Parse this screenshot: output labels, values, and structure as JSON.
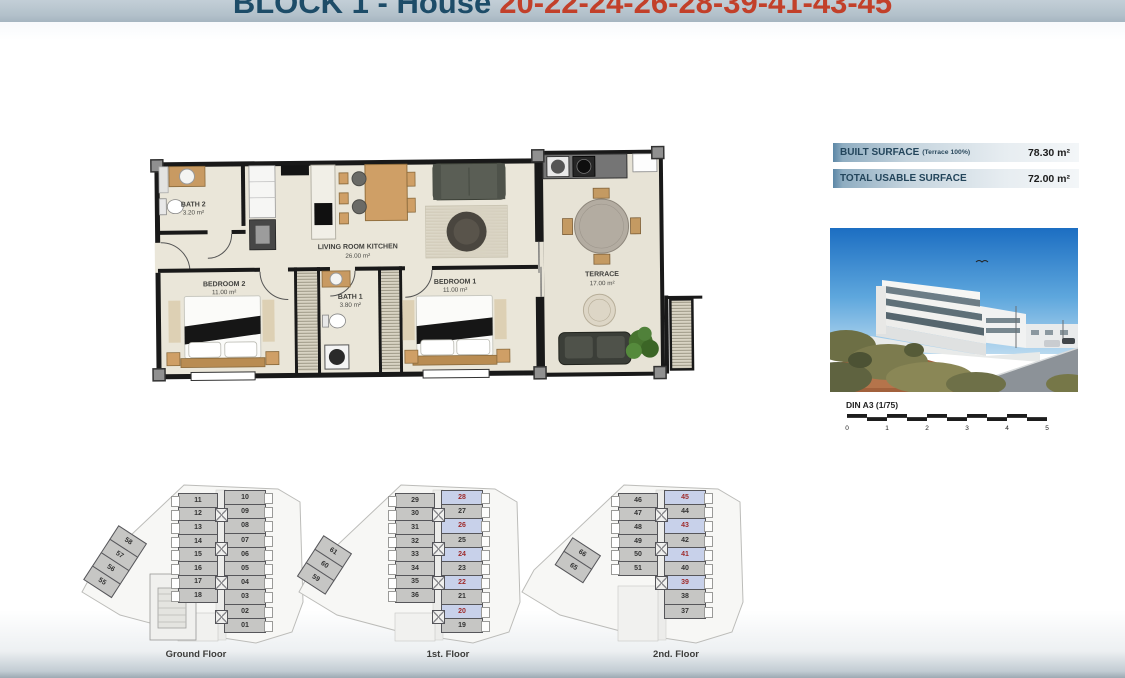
{
  "header": {
    "block_label": "BLOCK 1 - House",
    "house_numbers": "20-22-24-26-28-39-41-43-45"
  },
  "colors": {
    "title_text": "#1d4c68",
    "title_numbers": "#c2402a",
    "header_bar": "#b3c1cb",
    "unit_bg": "#c6c6c4",
    "unit_num": "#333333",
    "highlight_bg": "#c8d1ea",
    "highlight_num": "#9e2b2b"
  },
  "floor_plan": {
    "rooms": [
      {
        "id": "bath2",
        "name": "BATH 2",
        "area": "3.20 m²"
      },
      {
        "id": "living",
        "name": "LIVING ROOM KITCHEN",
        "area": "26.00 m²"
      },
      {
        "id": "bedroom2",
        "name": "BEDROOM 2",
        "area": "11.00 m²"
      },
      {
        "id": "bath1",
        "name": "BATH 1",
        "area": "3.80 m²"
      },
      {
        "id": "bedroom1",
        "name": "BEDROOM 1",
        "area": "11.00 m²"
      },
      {
        "id": "terrace",
        "name": "TERRACE",
        "area": "17.00 m²"
      }
    ]
  },
  "surface_table": {
    "rows": [
      {
        "label": "BUILT SURFACE",
        "note": "(Terrace 100%)",
        "value": "78.30 m²"
      },
      {
        "label": "TOTAL USABLE SURFACE",
        "note": "",
        "value": "72.00 m²"
      }
    ]
  },
  "scale_bar": {
    "label": "DIN A3 (1/75)",
    "ticks": [
      "0",
      "1",
      "2",
      "3",
      "4",
      "5"
    ]
  },
  "floors": [
    {
      "label": "Ground Floor",
      "side_units": [
        "58",
        "57",
        "56",
        "55"
      ],
      "middle_units": [
        "11",
        "12",
        "13",
        "14",
        "15",
        "16",
        "17",
        "18"
      ],
      "right_units": [
        "10",
        "09",
        "08",
        "07",
        "06",
        "05",
        "04",
        "03",
        "02",
        "01"
      ],
      "highlighted": []
    },
    {
      "label": "1st. Floor",
      "side_units": [
        "61",
        "60",
        "59"
      ],
      "middle_units": [
        "29",
        "30",
        "31",
        "32",
        "33",
        "34",
        "35",
        "36"
      ],
      "right_units": [
        "28",
        "27",
        "26",
        "25",
        "24",
        "23",
        "22",
        "21",
        "20",
        "19"
      ],
      "highlighted": [
        "28",
        "26",
        "24",
        "22",
        "20"
      ]
    },
    {
      "label": "2nd. Floor",
      "side_units": [
        "66",
        "65"
      ],
      "middle_units": [
        "46",
        "47",
        "48",
        "49",
        "50",
        "51"
      ],
      "right_units": [
        "45",
        "44",
        "43",
        "42",
        "41",
        "40",
        "39",
        "38",
        "37"
      ],
      "highlighted": [
        "45",
        "43",
        "41",
        "39"
      ]
    }
  ]
}
